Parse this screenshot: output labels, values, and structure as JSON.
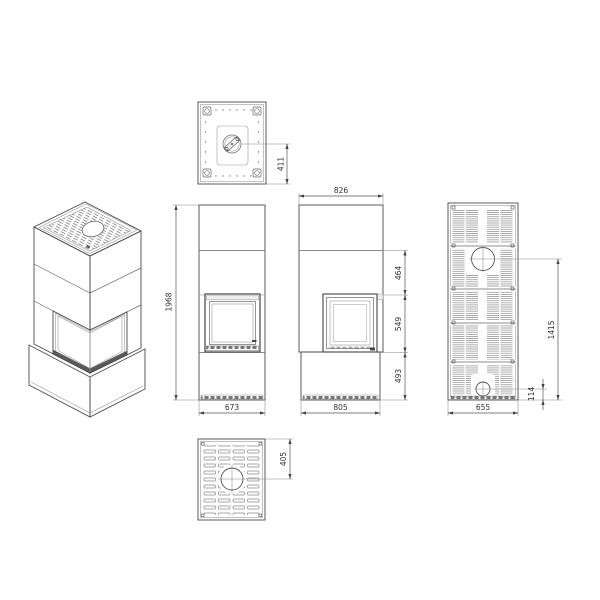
{
  "drawing": {
    "background": "#ffffff",
    "line_color": "#4a4a4a",
    "detail_line_color": "#8a8a8a",
    "dimension_line_color": "#555555",
    "text_color": "#333333",
    "views": {
      "top": {
        "flue_center_offset": "411"
      },
      "front": {
        "overall_height": "1968",
        "width": "673"
      },
      "side": {
        "depth_top": "826",
        "upper_section": "464",
        "window_height": "549",
        "base_height": "493",
        "depth_bottom": "805"
      },
      "rear": {
        "width": "655",
        "flue_center_height": "1415",
        "inlet_center_height": "114"
      },
      "bottom": {
        "inlet_center_offset": "405"
      }
    }
  }
}
